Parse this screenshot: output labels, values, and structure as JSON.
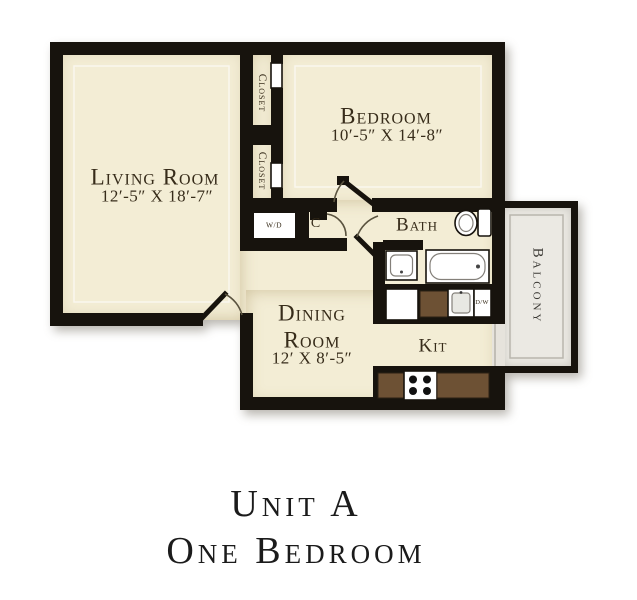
{
  "title": {
    "line1": "Unit A",
    "line2": "One Bedroom"
  },
  "plan": {
    "rooms": {
      "living_room": {
        "label": "Living Room",
        "dims": "12′-5″ X 18′-7″"
      },
      "bedroom": {
        "label": "Bedroom",
        "dims": "10′-5″ X 14′-8″"
      },
      "dining_room": {
        "label_line1": "Dining",
        "label_line2": "Room",
        "dims": "12′ X 8′-5″"
      },
      "kitchen": {
        "label": "Kit"
      },
      "bath": {
        "label": "Bath"
      },
      "balcony": {
        "label": "Balcony"
      },
      "closet_top": {
        "label": "Closet"
      },
      "closet_bottom": {
        "label": "Closet"
      },
      "coat_closet": {
        "label": "C"
      }
    },
    "appliances": {
      "washer_dryer": "W/D",
      "dishwasher": "D/W"
    }
  },
  "colors": {
    "wall": "#17130d",
    "floor": "#f3edd5",
    "balcony_floor": "#ebe9e3",
    "counter": "#6d5134",
    "label_text": "#372c1a",
    "title_text": "#1b1b1b"
  }
}
